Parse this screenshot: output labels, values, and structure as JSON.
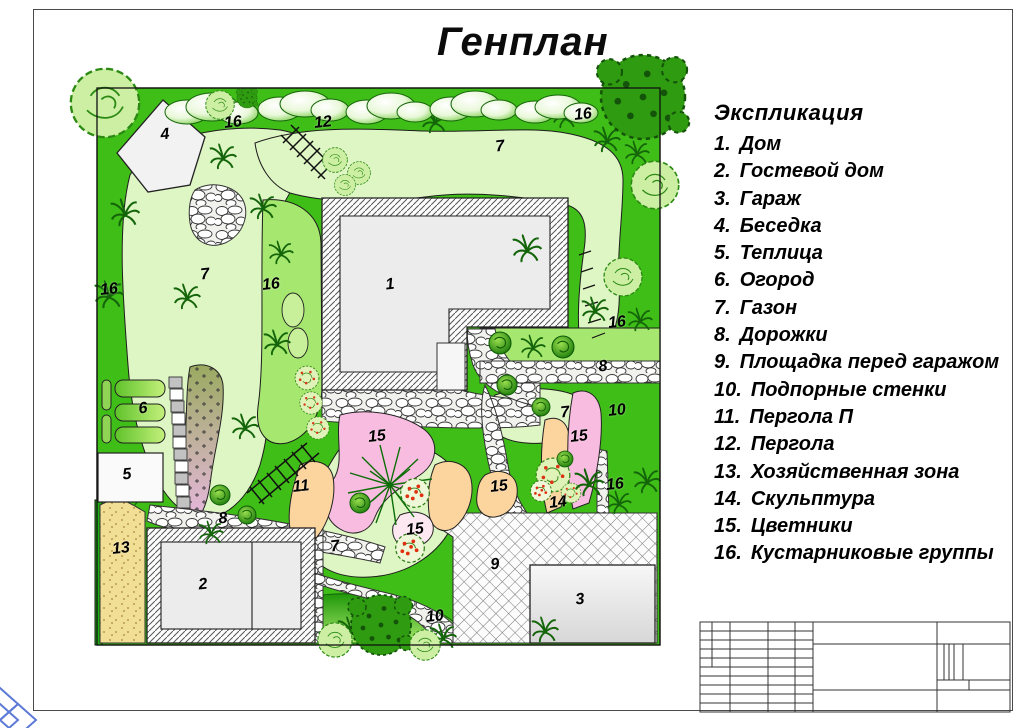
{
  "page": {
    "title": "Генплан"
  },
  "legend": {
    "title": "Экспликация",
    "items": [
      {
        "num": "1.",
        "label": "Дом"
      },
      {
        "num": "2.",
        "label": "Гостевой дом"
      },
      {
        "num": "3.",
        "label": "Гараж"
      },
      {
        "num": "4.",
        "label": "Беседка"
      },
      {
        "num": "5.",
        "label": "Теплица"
      },
      {
        "num": "6.",
        "label": "Огород"
      },
      {
        "num": "7.",
        "label": "Газон"
      },
      {
        "num": "8.",
        "label": "Дорожки"
      },
      {
        "num": "9.",
        "label": "Площадка перед гаражом"
      },
      {
        "num": "10.",
        "label": "Подпорные стенки"
      },
      {
        "num": "11.",
        "label": "Пергола  П"
      },
      {
        "num": "12.",
        "label": "Пергола"
      },
      {
        "num": "13.",
        "label": "Хозяйственная зона"
      },
      {
        "num": "14.",
        "label": "Скульптура"
      },
      {
        "num": "15.",
        "label": "Цветники"
      },
      {
        "num": "16.",
        "label": "Кустарниковые группы"
      }
    ]
  },
  "plan": {
    "labels": [
      {
        "t": "4",
        "x": 70,
        "y": 50
      },
      {
        "t": "16",
        "x": 138,
        "y": 38
      },
      {
        "t": "12",
        "x": 228,
        "y": 38
      },
      {
        "t": "7",
        "x": 405,
        "y": 62
      },
      {
        "t": "16",
        "x": 488,
        "y": 30
      },
      {
        "t": "1",
        "x": 295,
        "y": 200
      },
      {
        "t": "7",
        "x": 110,
        "y": 190
      },
      {
        "t": "16",
        "x": 176,
        "y": 200
      },
      {
        "t": "16",
        "x": 14,
        "y": 205
      },
      {
        "t": "16",
        "x": 522,
        "y": 238
      },
      {
        "t": "8",
        "x": 508,
        "y": 282
      },
      {
        "t": "7",
        "x": 470,
        "y": 328
      },
      {
        "t": "10",
        "x": 522,
        "y": 326
      },
      {
        "t": "15",
        "x": 484,
        "y": 352
      },
      {
        "t": "16",
        "x": 520,
        "y": 400
      },
      {
        "t": "14",
        "x": 463,
        "y": 418
      },
      {
        "t": "6",
        "x": 48,
        "y": 324
      },
      {
        "t": "5",
        "x": 32,
        "y": 390
      },
      {
        "t": "13",
        "x": 26,
        "y": 464
      },
      {
        "t": "11",
        "x": 206,
        "y": 402
      },
      {
        "t": "15",
        "x": 282,
        "y": 352
      },
      {
        "t": "8",
        "x": 128,
        "y": 434
      },
      {
        "t": "2",
        "x": 108,
        "y": 500
      },
      {
        "t": "7",
        "x": 240,
        "y": 462
      },
      {
        "t": "15",
        "x": 320,
        "y": 445
      },
      {
        "t": "15",
        "x": 404,
        "y": 402
      },
      {
        "t": "9",
        "x": 400,
        "y": 480
      },
      {
        "t": "3",
        "x": 485,
        "y": 515
      },
      {
        "t": "10",
        "x": 340,
        "y": 532
      }
    ]
  },
  "palette": {
    "base_green": "#3fbe17",
    "lawn_green": "#def5c4",
    "mid_green": "#a6e770",
    "flower_pink": "#f8bce0",
    "flower_orange": "#fbd49e",
    "sand_yellow": "#f2df96",
    "building_gray": "#ececec",
    "watermark_blue": "#5d7ad6",
    "line_black": "#111111"
  }
}
